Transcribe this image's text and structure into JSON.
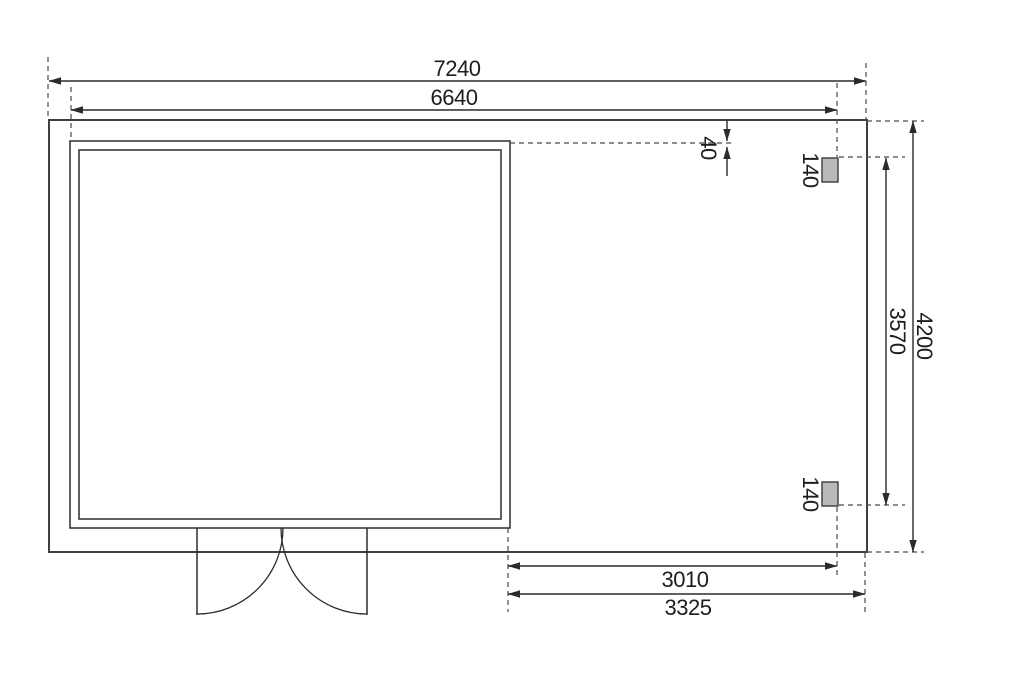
{
  "dimensions": {
    "overall_width": "7240",
    "cabin_width": "6640",
    "gap_roof_edge": "40",
    "post_top_size": "140",
    "post_bottom_size": "140",
    "post_span": "3570",
    "overall_depth": "4200",
    "annex_inner_width": "3010",
    "annex_outer_width": "3325"
  }
}
